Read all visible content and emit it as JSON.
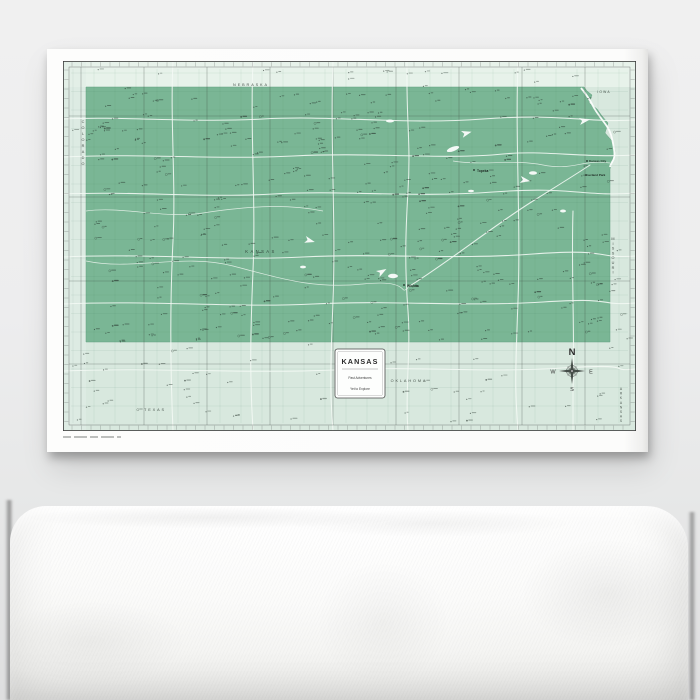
{
  "artwork": {
    "legend": {
      "title": "KANSAS",
      "subtitle1": "Past Adventures",
      "subtitle2": "Yet to Explore"
    },
    "compass": {
      "north": "N",
      "east": "E",
      "south": "S",
      "west": "W"
    },
    "state_label": "KANSAS",
    "region_labels": {
      "nebraska": "NEBRASKA",
      "iowa": "IOWA",
      "colorado": "COLORADO",
      "missouri": "MISSOURI",
      "arkansas": "ARKANSAS",
      "oklahoma": "OKLAHOMA",
      "texas": "TEXAS"
    },
    "city_labels": {
      "topeka": "Topeka",
      "kansas_city": "Kansas City",
      "overland_park": "Overland Park",
      "wichita": "Wichita"
    },
    "colors": {
      "state_fill": "#7ab695",
      "state_stroke": "#64a181",
      "map_background": "#d8e8de",
      "north_strip": "#e7f2ea",
      "west_strip": "#e0ede5",
      "canvas": "#fdfdfc"
    }
  }
}
